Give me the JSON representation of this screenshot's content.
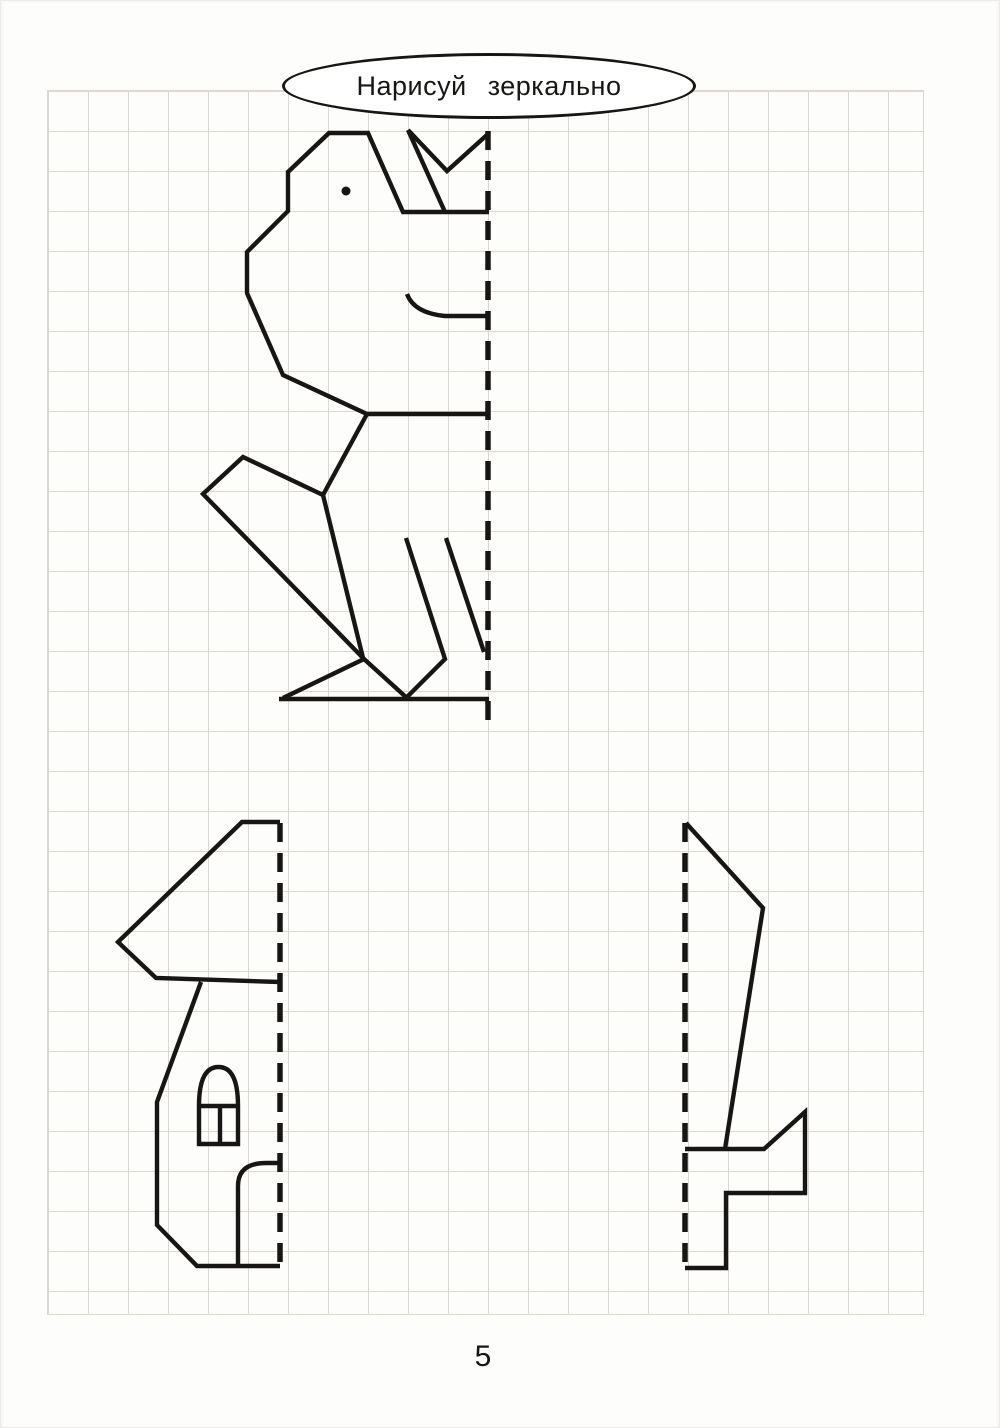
{
  "page": {
    "title": "Нарисуй зеркально",
    "page_number": "5",
    "colors": {
      "ink": "#171614",
      "grid": "#dcd8cf",
      "paper": "#fdfdfc"
    }
  },
  "worksheet": {
    "figures": [
      {
        "id": "dog",
        "label": "half drawing of a sitting dog to be mirrored",
        "mirror_line": {
          "x": 488,
          "y1": 131,
          "y2": 727
        },
        "polylines": [
          [
            [
              489,
              212
            ],
            [
              403,
              212
            ],
            [
              368,
              133
            ],
            [
              329,
              133
            ],
            [
              288,
              172
            ],
            [
              288,
              211
            ],
            [
              247,
              252
            ],
            [
              247,
              293
            ],
            [
              283,
              375
            ],
            [
              367,
              414
            ],
            [
              488,
              414
            ]
          ],
          [
            [
              408,
              130
            ],
            [
              445,
              212
            ]
          ],
          [
            [
              408,
              130
            ],
            [
              447,
              171
            ],
            [
              488,
              134
            ]
          ],
          [
            [
              367,
              414
            ],
            [
              323,
              495
            ],
            [
              363,
              658
            ]
          ],
          [
            [
              323,
              495
            ],
            [
              243,
              457
            ],
            [
              203,
              494
            ],
            [
              364,
              659
            ]
          ],
          [
            [
              283,
              698
            ],
            [
              364,
              659
            ],
            [
              407,
              698
            ]
          ],
          [
            [
              279,
              699
            ],
            [
              489,
              699
            ]
          ],
          [
            [
              406,
              538
            ],
            [
              445,
              659
            ],
            [
              407,
              697
            ]
          ],
          [
            [
              446,
              538
            ],
            [
              484,
              652
            ]
          ]
        ],
        "paths": [
          "M407,294 Q414,313 445,316 L489,316"
        ],
        "dots": [
          {
            "cx": 346,
            "cy": 191,
            "r": 4.5
          }
        ]
      },
      {
        "id": "house",
        "label": "half drawing of a house with arched window and door to be mirrored",
        "mirror_line": {
          "x": 280,
          "y1": 823,
          "y2": 1267
        },
        "polylines": [
          [
            [
              280,
              822
            ],
            [
              242,
              822
            ],
            [
              118,
              942
            ],
            [
              156,
              978
            ],
            [
              280,
              982
            ]
          ],
          [
            [
              201,
              982
            ],
            [
              157,
              1102
            ],
            [
              157,
              1225
            ],
            [
              197,
              1266
            ],
            [
              280,
              1266
            ]
          ],
          [
            [
              199,
              1106
            ],
            [
              238,
              1106
            ]
          ],
          [
            [
              220,
              1106
            ],
            [
              220,
              1144
            ]
          ]
        ],
        "paths": [
          "M199,1144 L199,1106 Q199,1067 218.5,1067 Q238,1067 238,1106 L238,1144 Z",
          "M238,1266 L238,1186 Q238,1163 266,1163 L280,1163"
        ],
        "dots": []
      },
      {
        "id": "sword",
        "label": "half drawing of a sword to be mirrored",
        "mirror_line": {
          "x": 685,
          "y1": 823,
          "y2": 1268
        },
        "polylines": [
          [
            [
              686,
              823
            ],
            [
              763,
              908
            ],
            [
              725,
              1149
            ]
          ],
          [
            [
              685,
              1149
            ],
            [
              764,
              1149
            ],
            [
              805,
              1112
            ],
            [
              805,
              1193
            ],
            [
              726,
              1193
            ],
            [
              726,
              1268
            ],
            [
              685,
              1268
            ]
          ]
        ],
        "paths": [],
        "dots": []
      }
    ]
  }
}
